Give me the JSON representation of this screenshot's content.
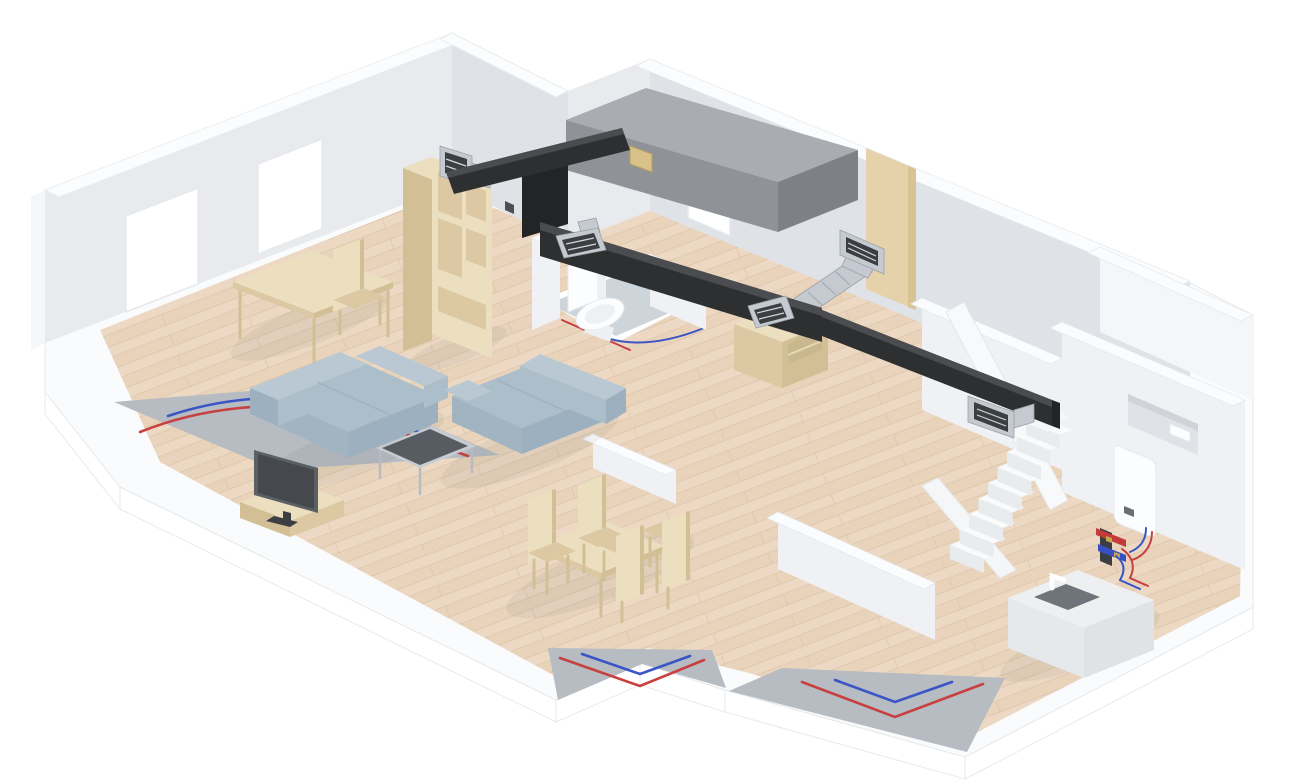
{
  "scene": {
    "type": "3d-isometric-architectural-rendering",
    "description": "Cutaway 3D floor plan of a house ground floor showing a mechanical ventilation heat recovery (MVHR) system with a gray ceiling unit, black insulated distribution ducting with air valves, a galvanised branch duct to a wall grille, a wall-mounted boiler with underfloor-heating manifold, red and blue underfloor heating pipe loops embedded in gray screed at the floor cut edges, a white staircase, and furnished rooms (sofas, coffee table, TV, desk, shelving, dining set, toilet, sideboard, kitchen island).",
    "rooms": [
      "living-room",
      "dining-area",
      "bathroom",
      "hallway",
      "stair-hall",
      "utility-room",
      "kitchen"
    ],
    "colors": {
      "background": "#ffffff",
      "slab_top": "#fafbfc",
      "slab_side": "#ffffff",
      "slab_edge": "#e7eaec",
      "wall_face": "#e8eaed",
      "wall_face_dark": "#dfe2e6",
      "wall_top": "#fbfcfd",
      "wall_interior": "#eff1f4",
      "wall_outer": "#f4f6f8",
      "floor_wood": "#edd9c3",
      "floor_wood_stripe": "#e5cdb4",
      "floor_wood_line": "#d8bfa3",
      "bathroom_tile": "#cdd4da",
      "screed": "#b6bcc2",
      "pipe_red": "#c84040",
      "pipe_blue": "#3b55c6",
      "duct_black": "#2e2f31",
      "duct_black_top": "#4a4c4f",
      "duct_black_dark": "#232426",
      "metal": "#c5cad0",
      "metal_dark": "#3c3f42",
      "metal_edge": "#9aa1a8",
      "hrv_top": "#a9adb1",
      "hrv_front": "#8f9397",
      "hrv_side": "#7d8185",
      "filter_beige": "#d9c28a",
      "furniture_wood": "#ecdfc0",
      "furniture_wood_dark": "#dcc9a4",
      "furniture_wood_side": "#d2bf96",
      "sofa": "#adbecb",
      "sofa_dark": "#9cb0bf",
      "sofa_deep": "#a2b4c2",
      "sofa_light": "#bac8d3",
      "glass": "#565c61",
      "tv_panel": "#5b6065",
      "tv_screen": "#45494e",
      "hob": "#6f747a",
      "door_tan": "#e5d2ab",
      "door_tan_dark": "#d9c293",
      "white_object": "#fcfdfe",
      "niche": "#dfe2e6",
      "shadow": "rgba(70,80,90,0.07)"
    },
    "components": [
      {
        "name": "mvhr-unit",
        "label": "Heat recovery ventilation unit with beige filter panel"
      },
      {
        "name": "main-duct",
        "label": "Black insulated air distribution duct along ceiling"
      },
      {
        "name": "branch-duct",
        "label": "Galvanised branch duct to wall grille"
      },
      {
        "name": "air-valves",
        "label": "Supply and extract air valves",
        "count": 5
      },
      {
        "name": "underfloor-heating-loops",
        "label": "Underfloor heating pipes, red flow and blue return, in screed cutaways",
        "count": 5
      },
      {
        "name": "boiler",
        "label": "Wall-mounted boiler"
      },
      {
        "name": "heating-manifold",
        "label": "Underfloor heating manifold with red and blue headers"
      },
      {
        "name": "staircase",
        "label": "White staircase with railing"
      },
      {
        "name": "windows",
        "label": "Windows",
        "count": 3
      },
      {
        "name": "wall-niche",
        "label": "Recessed niche in right wall"
      },
      {
        "name": "door",
        "label": "Wooden door in back wall"
      },
      {
        "name": "sofas",
        "label": "Blue-gray sofas",
        "count": 2
      },
      {
        "name": "coffee-table",
        "label": "Glass coffee table"
      },
      {
        "name": "tv",
        "label": "Flat screen TV"
      },
      {
        "name": "tv-stand",
        "label": "Low wooden TV stand"
      },
      {
        "name": "desk",
        "label": "Wooden desk"
      },
      {
        "name": "desk-chair",
        "label": "Desk chair"
      },
      {
        "name": "shelving-unit",
        "label": "Tall wooden shelving unit"
      },
      {
        "name": "sideboard",
        "label": "Low wooden sideboard"
      },
      {
        "name": "dining-table",
        "label": "Wooden dining table"
      },
      {
        "name": "dining-chairs",
        "label": "High-back dining chairs",
        "count": 4
      },
      {
        "name": "toilet",
        "label": "Toilet"
      },
      {
        "name": "kitchen-island",
        "label": "Kitchen island with dark hob and faucet"
      }
    ]
  }
}
